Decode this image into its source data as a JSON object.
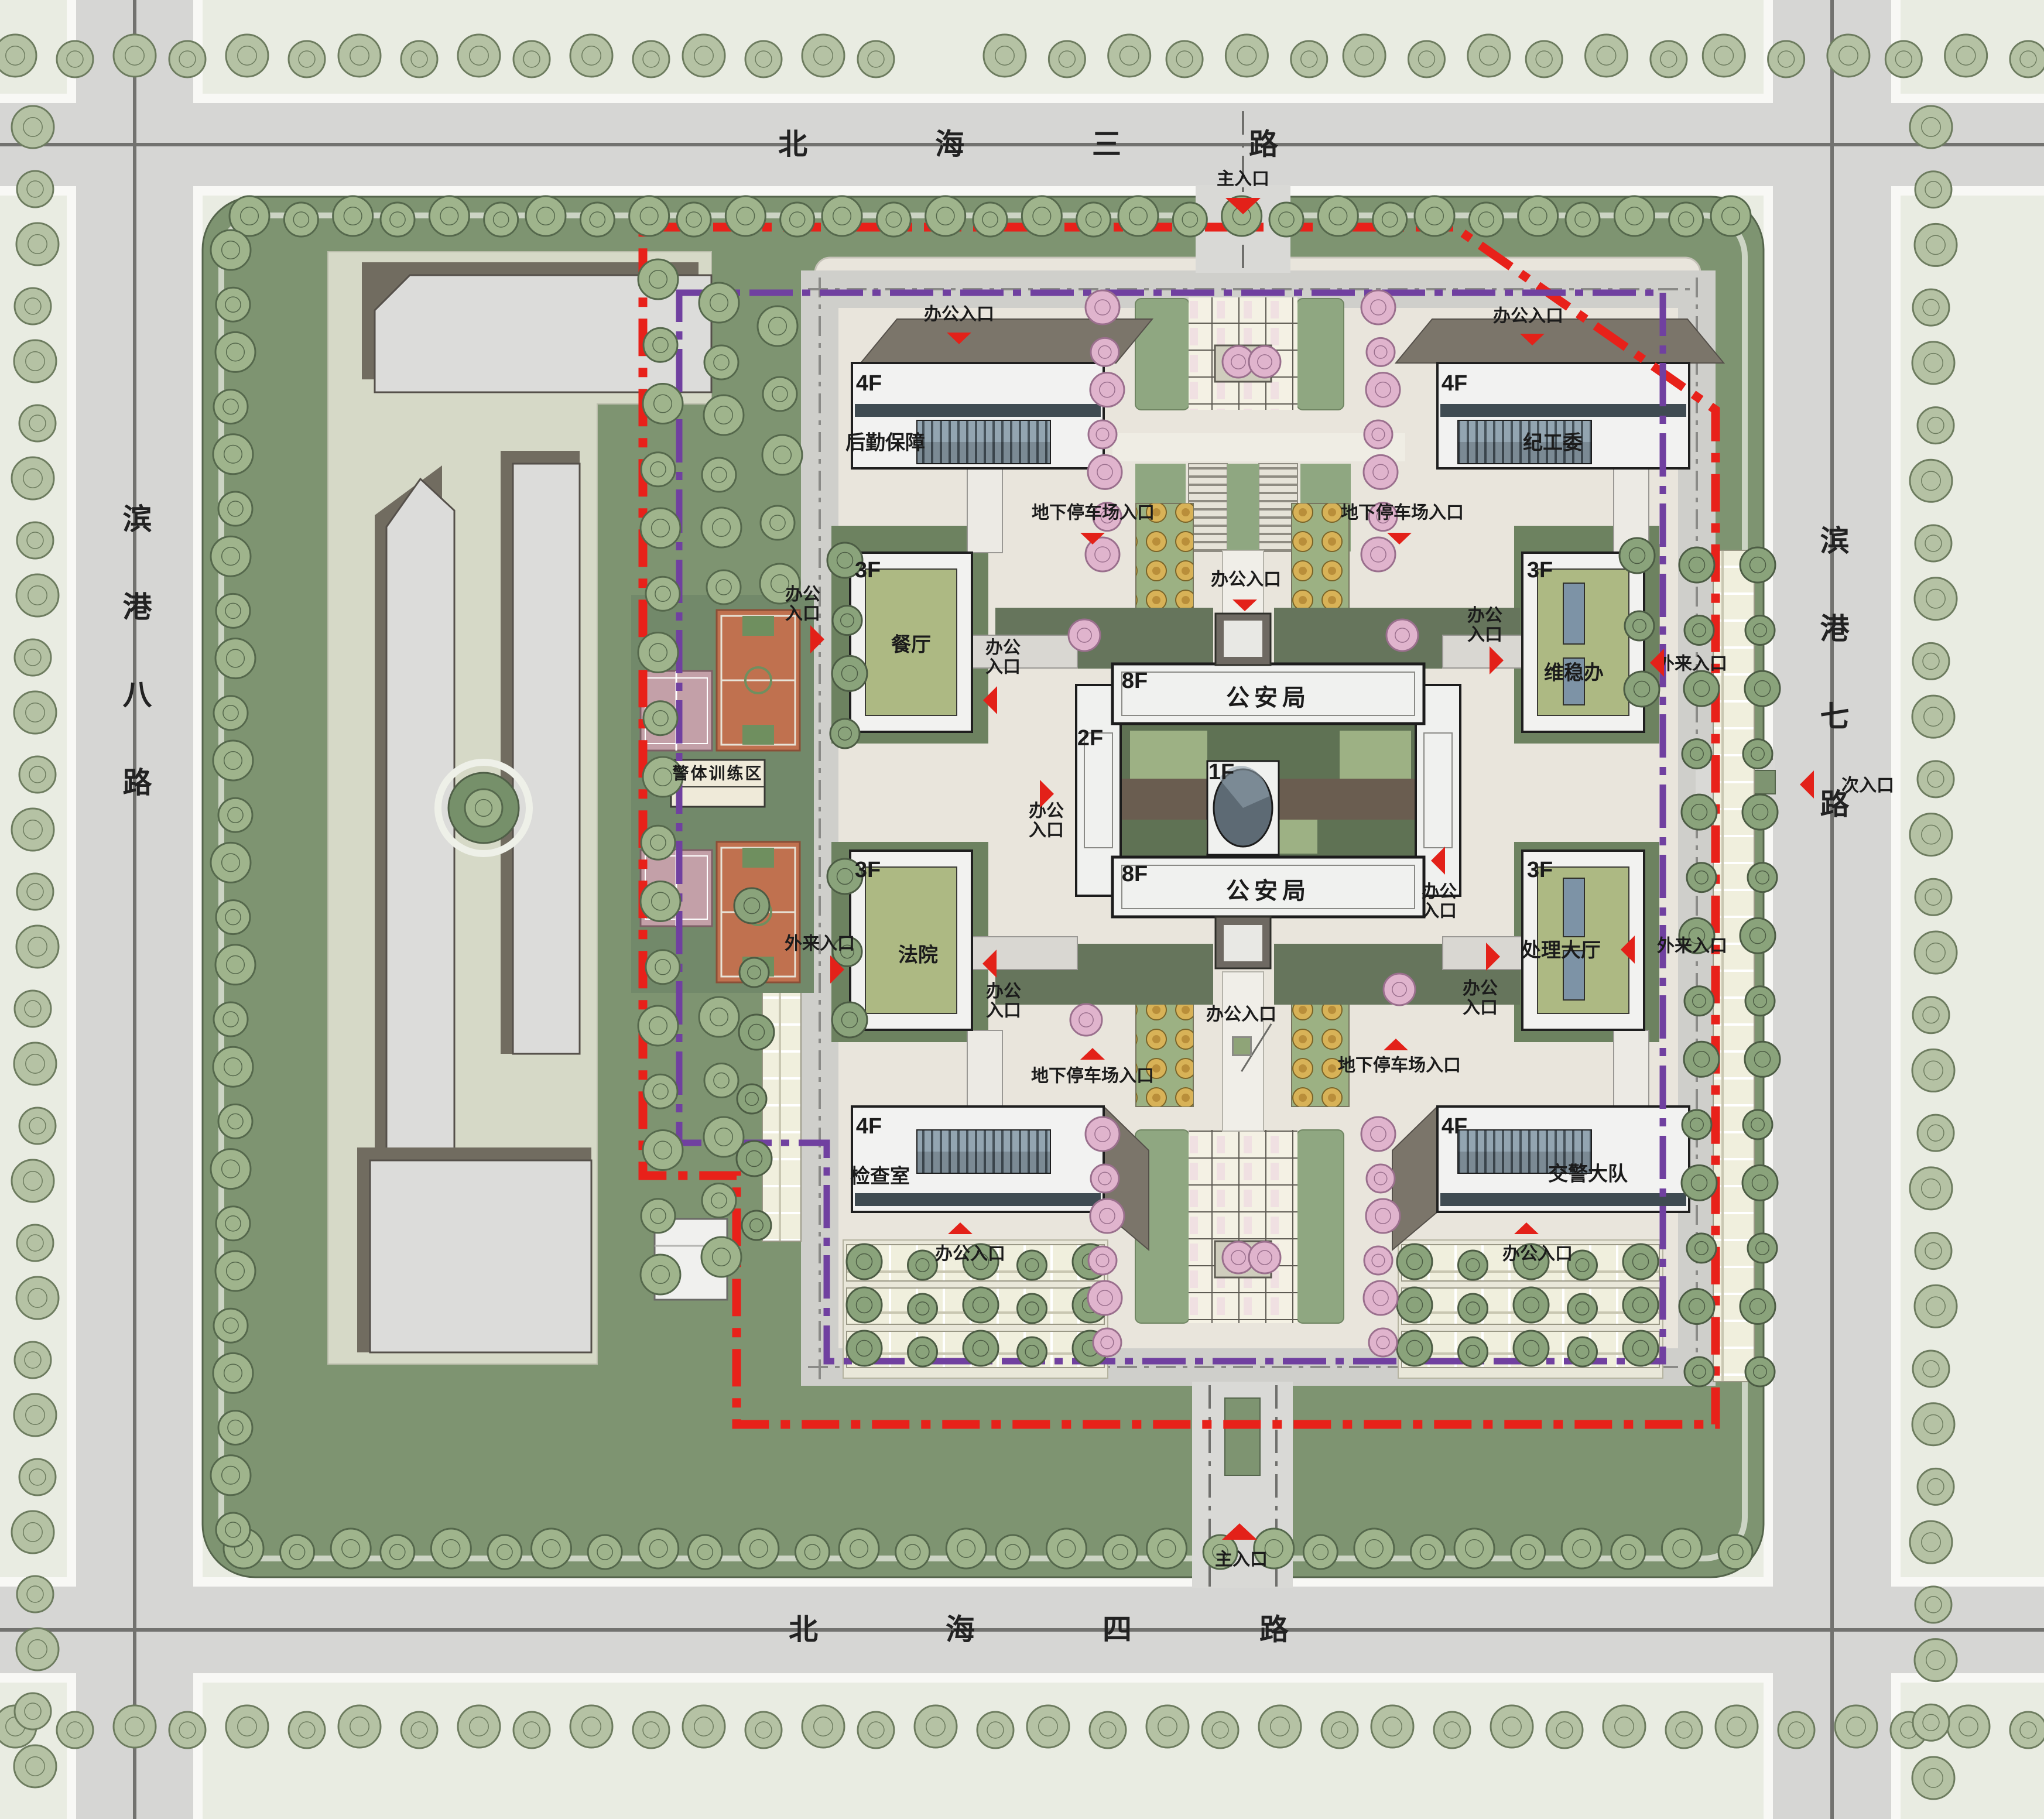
{
  "meta": {
    "type": "architectural-master-plan",
    "description": "Site master plan of a police / government campus bounded by four city roads"
  },
  "roads": {
    "north": "北海三路",
    "south": "北海四路",
    "west": "滨港八路",
    "east": "滨港七路"
  },
  "entrances": {
    "main": "主入口",
    "secondary": "次入口",
    "office": "办公入口",
    "visitor": "外来入口",
    "underground_parking": "地下停车场入口"
  },
  "zones": {
    "police_training": "警体训练区"
  },
  "buildings": {
    "logistics": {
      "name": "后勤保障",
      "floors": "4F"
    },
    "discipline_committee": {
      "name": "纪工委",
      "floors": "4F"
    },
    "canteen": {
      "name": "餐厅",
      "floors": "3F"
    },
    "stability_office": {
      "name": "维稳办",
      "floors": "3F"
    },
    "courthouse": {
      "name": "法院",
      "floors": "3F"
    },
    "processing_hall": {
      "name": "处理大厅",
      "floors": "3F"
    },
    "inspection_room": {
      "name": "检查室",
      "floors": "4F"
    },
    "traffic_police": {
      "name": "交警大队",
      "floors": "4F"
    },
    "public_security_bureau": {
      "name": "公安局",
      "floors": "8F"
    },
    "podium": {
      "floors": "2F"
    },
    "central_core": {
      "floors": "1F"
    }
  },
  "colors": {
    "boundary_red": "#e8211a",
    "boundary_purple": "#7040a0",
    "arrow_red": "#e32119",
    "site_green": "#7e9471",
    "campus_paving": "#e9e5dc",
    "building_white": "#f1f1ef",
    "roof_green": "#adb983",
    "roof_taupe": "#7b756a",
    "window_band": "#93a5b1",
    "court_orange": "#c0714f",
    "court_pink": "#c3a0a8",
    "blossom_pink": "#d9abc6"
  }
}
